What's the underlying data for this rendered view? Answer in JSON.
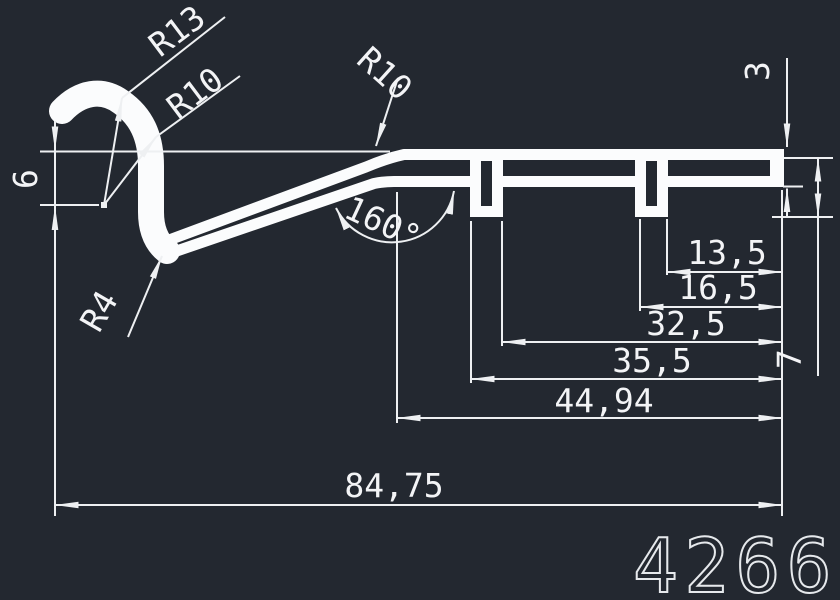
{
  "drawing": {
    "part_number": "4266",
    "colors": {
      "background": "#232830",
      "profile": "#fbfcfd",
      "lines": "#eef0f2",
      "text": "#f3f4f6"
    },
    "linear_dimensions": [
      {
        "label": "13,5",
        "value": 13.5,
        "orientation": "horizontal"
      },
      {
        "label": "16,5",
        "value": 16.5,
        "orientation": "horizontal"
      },
      {
        "label": "32,5",
        "value": 32.5,
        "orientation": "horizontal"
      },
      {
        "label": "35,5",
        "value": 35.5,
        "orientation": "horizontal"
      },
      {
        "label": "44,94",
        "value": 44.94,
        "orientation": "horizontal"
      },
      {
        "label": "84,75",
        "value": 84.75,
        "orientation": "horizontal"
      },
      {
        "label": "6",
        "value": 6,
        "orientation": "vertical"
      },
      {
        "label": "3",
        "value": 3,
        "orientation": "vertical"
      },
      {
        "label": "7",
        "value": 7,
        "orientation": "vertical"
      }
    ],
    "angle_dimension": {
      "label": "160°",
      "value": 160
    },
    "radius_dimensions": [
      {
        "label": "R13",
        "value": 13
      },
      {
        "label": "R10",
        "value": 10
      },
      {
        "label": "R10",
        "value": 10
      },
      {
        "label": "R4",
        "value": 4
      }
    ]
  }
}
